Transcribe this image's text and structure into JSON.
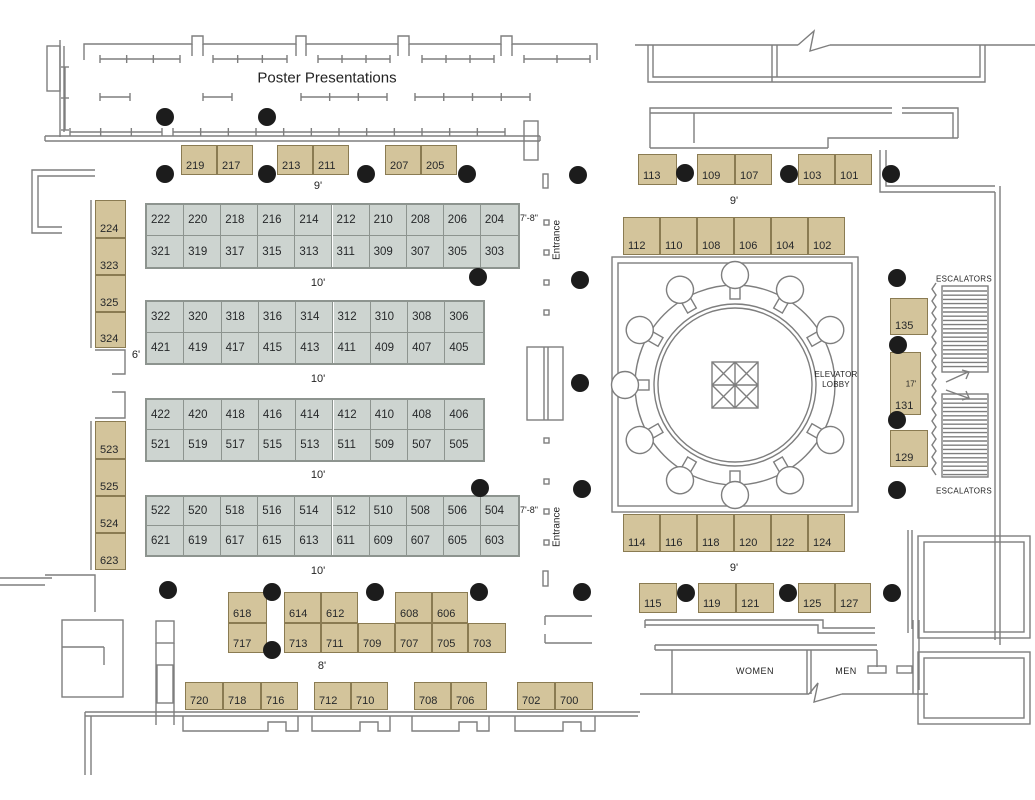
{
  "texts": {
    "poster": "Poster Presentations",
    "entrance": "Entrance",
    "elevator_lobby_line1": "ELEVATOR",
    "elevator_lobby_line2": "LOBBY",
    "escalators": "ESCALATORS",
    "women": "WOMEN",
    "men": "MEN"
  },
  "colors": {
    "tan_booth_fill": "#d3c49b",
    "tan_booth_border": "#8a7b52",
    "gray_booth_fill": "#cdd4d0",
    "gray_booth_border": "#8d948f",
    "wall": "#7e7e7e",
    "column_dot": "#1c1c1c",
    "text": "#232323"
  },
  "dimension_labels": [
    {
      "t": "9'",
      "x": 318,
      "y": 186
    },
    {
      "t": "10'",
      "x": 318,
      "y": 283
    },
    {
      "t": "10'",
      "x": 318,
      "y": 379
    },
    {
      "t": "10'",
      "x": 318,
      "y": 475
    },
    {
      "t": "10'",
      "x": 318,
      "y": 571
    },
    {
      "t": "7'-8\"",
      "x": 529,
      "y": 218,
      "s": 9
    },
    {
      "t": "7'-8\"",
      "x": 529,
      "y": 510,
      "s": 9
    },
    {
      "t": "6'",
      "x": 136,
      "y": 355
    },
    {
      "t": "8'",
      "x": 322,
      "y": 666
    },
    {
      "t": "9'",
      "x": 734,
      "y": 201
    },
    {
      "t": "9'",
      "x": 734,
      "y": 568
    },
    {
      "t": "17'",
      "x": 911,
      "y": 384,
      "s": 8
    }
  ],
  "grid_blocks": [
    {
      "x": 147,
      "y": 205,
      "cw": 37.1,
      "ch": 31,
      "rows": [
        [
          "222",
          "220",
          "218",
          "216",
          "214",
          "212",
          "210",
          "208",
          "206",
          "204"
        ],
        [
          "321",
          "319",
          "317",
          "315",
          "313",
          "311",
          "309",
          "307",
          "305",
          "303"
        ]
      ]
    },
    {
      "x": 147,
      "y": 302,
      "cw": 37.3,
      "ch": 30.5,
      "rows": [
        [
          "322",
          "320",
          "318",
          "316",
          "314",
          "312",
          "310",
          "308",
          "306"
        ],
        [
          "421",
          "419",
          "417",
          "415",
          "413",
          "411",
          "409",
          "407",
          "405"
        ]
      ]
    },
    {
      "x": 147,
      "y": 400,
      "cw": 37.3,
      "ch": 30,
      "rows": [
        [
          "422",
          "420",
          "418",
          "416",
          "414",
          "412",
          "410",
          "408",
          "406"
        ],
        [
          "521",
          "519",
          "517",
          "515",
          "513",
          "511",
          "509",
          "507",
          "505"
        ]
      ]
    },
    {
      "x": 147,
      "y": 497,
      "cw": 37.1,
      "ch": 29,
      "rows": [
        [
          "522",
          "520",
          "518",
          "516",
          "514",
          "512",
          "510",
          "508",
          "506",
          "504"
        ],
        [
          "621",
          "619",
          "617",
          "615",
          "613",
          "611",
          "609",
          "607",
          "605",
          "603"
        ]
      ]
    }
  ],
  "booths": [
    {
      "t": "219",
      "x": 181,
      "y": 145,
      "w": 36,
      "h": 30
    },
    {
      "t": "217",
      "x": 217,
      "y": 145,
      "w": 36,
      "h": 30
    },
    {
      "t": "213",
      "x": 277,
      "y": 145,
      "w": 36,
      "h": 30
    },
    {
      "t": "211",
      "x": 313,
      "y": 145,
      "w": 36,
      "h": 30
    },
    {
      "t": "207",
      "x": 385,
      "y": 145,
      "w": 36,
      "h": 30
    },
    {
      "t": "205",
      "x": 421,
      "y": 145,
      "w": 36,
      "h": 30
    },
    {
      "t": "224",
      "x": 95,
      "y": 200,
      "w": 31,
      "h": 38
    },
    {
      "t": "323",
      "x": 95,
      "y": 238,
      "w": 31,
      "h": 37
    },
    {
      "t": "325",
      "x": 95,
      "y": 275,
      "w": 31,
      "h": 37
    },
    {
      "t": "324",
      "x": 95,
      "y": 312,
      "w": 31,
      "h": 36
    },
    {
      "t": "523",
      "x": 95,
      "y": 421,
      "w": 31,
      "h": 38
    },
    {
      "t": "525",
      "x": 95,
      "y": 459,
      "w": 31,
      "h": 37
    },
    {
      "t": "524",
      "x": 95,
      "y": 496,
      "w": 31,
      "h": 37
    },
    {
      "t": "623",
      "x": 95,
      "y": 533,
      "w": 31,
      "h": 37
    },
    {
      "t": "618",
      "x": 228,
      "y": 592,
      "w": 39,
      "h": 31
    },
    {
      "t": "717",
      "x": 228,
      "y": 623,
      "w": 39,
      "h": 30
    },
    {
      "t": "614",
      "x": 284,
      "y": 592,
      "w": 37,
      "h": 31
    },
    {
      "t": "612",
      "x": 321,
      "y": 592,
      "w": 37,
      "h": 31
    },
    {
      "t": "713",
      "x": 284,
      "y": 623,
      "w": 37,
      "h": 30
    },
    {
      "t": "711",
      "x": 321,
      "y": 623,
      "w": 37,
      "h": 30
    },
    {
      "t": "709",
      "x": 358,
      "y": 623,
      "w": 37,
      "h": 30
    },
    {
      "t": "608",
      "x": 395,
      "y": 592,
      "w": 37,
      "h": 31
    },
    {
      "t": "606",
      "x": 432,
      "y": 592,
      "w": 36,
      "h": 31
    },
    {
      "t": "707",
      "x": 395,
      "y": 623,
      "w": 37,
      "h": 30
    },
    {
      "t": "705",
      "x": 432,
      "y": 623,
      "w": 36,
      "h": 30
    },
    {
      "t": "703",
      "x": 468,
      "y": 623,
      "w": 38,
      "h": 30
    },
    {
      "t": "720",
      "x": 185,
      "y": 682,
      "w": 38,
      "h": 28
    },
    {
      "t": "718",
      "x": 223,
      "y": 682,
      "w": 38,
      "h": 28
    },
    {
      "t": "716",
      "x": 261,
      "y": 682,
      "w": 37,
      "h": 28
    },
    {
      "t": "712",
      "x": 314,
      "y": 682,
      "w": 37,
      "h": 28
    },
    {
      "t": "710",
      "x": 351,
      "y": 682,
      "w": 37,
      "h": 28
    },
    {
      "t": "708",
      "x": 414,
      "y": 682,
      "w": 37,
      "h": 28
    },
    {
      "t": "706",
      "x": 451,
      "y": 682,
      "w": 36,
      "h": 28
    },
    {
      "t": "702",
      "x": 517,
      "y": 682,
      "w": 38,
      "h": 28
    },
    {
      "t": "700",
      "x": 555,
      "y": 682,
      "w": 38,
      "h": 28
    },
    {
      "t": "113",
      "x": 638,
      "y": 154,
      "w": 39,
      "h": 31
    },
    {
      "t": "109",
      "x": 697,
      "y": 154,
      "w": 38,
      "h": 31
    },
    {
      "t": "107",
      "x": 735,
      "y": 154,
      "w": 37,
      "h": 31
    },
    {
      "t": "103",
      "x": 798,
      "y": 154,
      "w": 37,
      "h": 31
    },
    {
      "t": "101",
      "x": 835,
      "y": 154,
      "w": 37,
      "h": 31
    },
    {
      "t": "112",
      "x": 623,
      "y": 217,
      "w": 37,
      "h": 38
    },
    {
      "t": "110",
      "x": 660,
      "y": 217,
      "w": 37,
      "h": 38
    },
    {
      "t": "108",
      "x": 697,
      "y": 217,
      "w": 37,
      "h": 38
    },
    {
      "t": "106",
      "x": 734,
      "y": 217,
      "w": 37,
      "h": 38
    },
    {
      "t": "104",
      "x": 771,
      "y": 217,
      "w": 37,
      "h": 38
    },
    {
      "t": "102",
      "x": 808,
      "y": 217,
      "w": 37,
      "h": 38
    },
    {
      "t": "135",
      "x": 890,
      "y": 298,
      "w": 38,
      "h": 37
    },
    {
      "t": "131",
      "x": 890,
      "y": 352,
      "w": 31,
      "h": 63
    },
    {
      "t": "129",
      "x": 890,
      "y": 430,
      "w": 38,
      "h": 37
    },
    {
      "t": "114",
      "x": 623,
      "y": 514,
      "w": 37,
      "h": 38
    },
    {
      "t": "116",
      "x": 660,
      "y": 514,
      "w": 37,
      "h": 38
    },
    {
      "t": "118",
      "x": 697,
      "y": 514,
      "w": 37,
      "h": 38
    },
    {
      "t": "120",
      "x": 734,
      "y": 514,
      "w": 37,
      "h": 38
    },
    {
      "t": "122",
      "x": 771,
      "y": 514,
      "w": 37,
      "h": 38
    },
    {
      "t": "124",
      "x": 808,
      "y": 514,
      "w": 37,
      "h": 38
    },
    {
      "t": "115",
      "x": 639,
      "y": 583,
      "w": 38,
      "h": 30
    },
    {
      "t": "119",
      "x": 698,
      "y": 583,
      "w": 38,
      "h": 30
    },
    {
      "t": "121",
      "x": 736,
      "y": 583,
      "w": 38,
      "h": 30
    },
    {
      "t": "125",
      "x": 798,
      "y": 583,
      "w": 37,
      "h": 30
    },
    {
      "t": "127",
      "x": 835,
      "y": 583,
      "w": 36,
      "h": 30
    }
  ],
  "dots": [
    [
      165,
      117
    ],
    [
      267,
      117
    ],
    [
      165,
      174
    ],
    [
      267,
      174
    ],
    [
      366,
      174
    ],
    [
      467,
      174
    ],
    [
      578,
      175
    ],
    [
      478,
      277
    ],
    [
      580,
      280
    ],
    [
      580,
      383
    ],
    [
      480,
      488
    ],
    [
      582,
      489
    ],
    [
      168,
      590
    ],
    [
      272,
      592
    ],
    [
      375,
      592
    ],
    [
      479,
      592
    ],
    [
      582,
      592
    ],
    [
      272,
      650
    ],
    [
      685,
      173
    ],
    [
      789,
      174
    ],
    [
      891,
      174
    ],
    [
      897,
      278
    ],
    [
      898,
      345
    ],
    [
      897,
      420
    ],
    [
      897,
      490
    ],
    [
      686,
      593
    ],
    [
      788,
      593
    ],
    [
      892,
      593
    ]
  ]
}
